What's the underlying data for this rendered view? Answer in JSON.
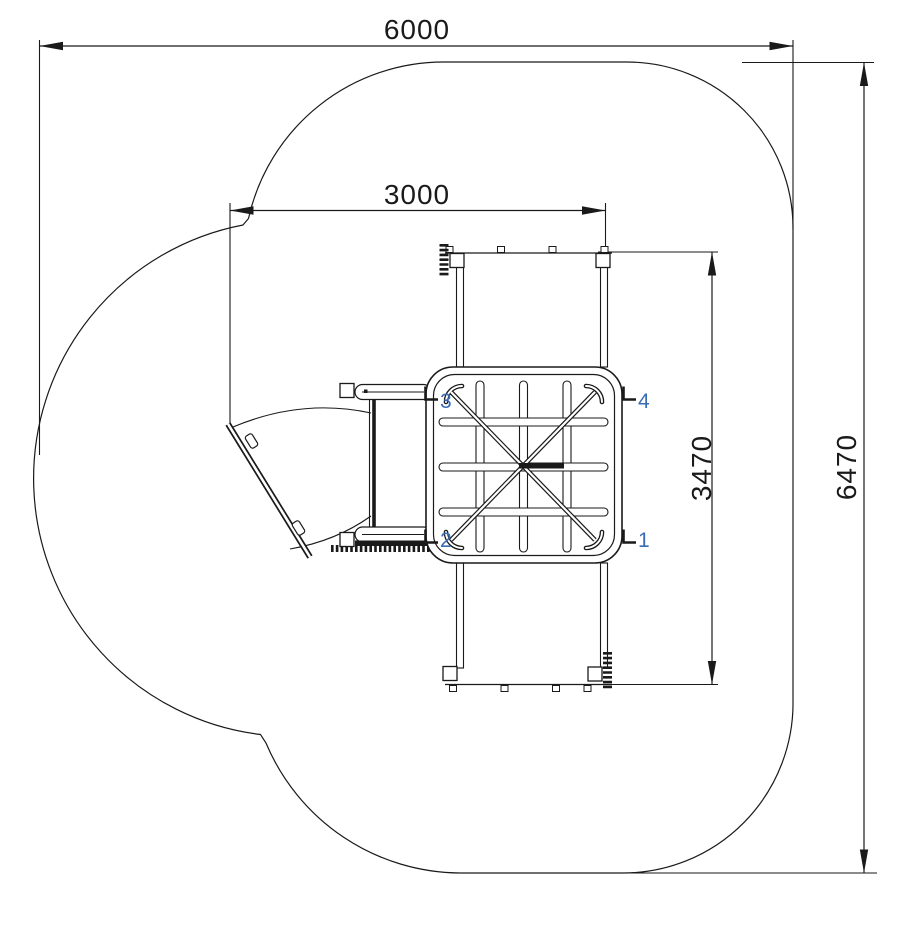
{
  "colors": {
    "line": "#1a1a1a",
    "background": "#ffffff",
    "dimension_text": "#1a1a1a",
    "dimension_text_blue": "#2a58ad",
    "corner_label_blue": "#3a6cb5"
  },
  "dimensions": {
    "total_width": "6000",
    "inner_width": "3000",
    "inner_height": "3470",
    "total_height": "6470"
  },
  "corner_labels": [
    "1",
    "2",
    "3",
    "4"
  ]
}
